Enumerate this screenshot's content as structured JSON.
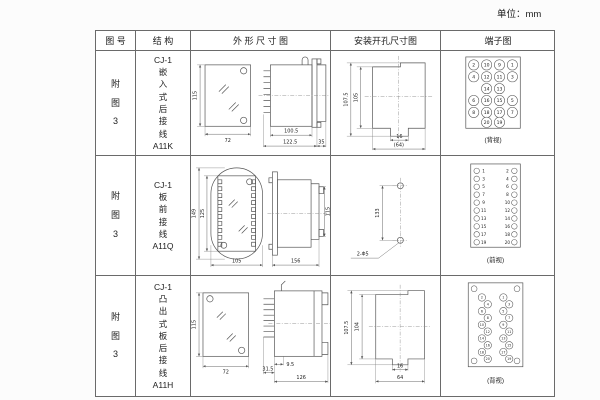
{
  "unit_label": "单位：mm",
  "header": {
    "col_figure": "图 号",
    "col_structure": "结 构",
    "col_outline": "外 形 尺 寸 图",
    "col_install": "安装开孔尺寸图",
    "col_terminal": "端子图"
  },
  "rows": [
    {
      "figure": "附\n图\n3",
      "structure": "CJ-1\n嵌\n入\n式\n后\n接\n线\nA11K",
      "outline": {
        "front_h": "115",
        "front_w": "72",
        "side_body": "100.5",
        "side_total": "122.5",
        "side_rear": "35"
      },
      "install": {
        "outer_h": "107.5",
        "inner_h": "105",
        "notch_w": "16",
        "total_w": "(64)"
      },
      "terminal": {
        "view_label": "(背视)",
        "circles": [
          {
            "x": 33,
            "y": 14,
            "n": "2"
          },
          {
            "x": 46,
            "y": 14,
            "n": "10"
          },
          {
            "x": 59,
            "y": 14,
            "n": "9"
          },
          {
            "x": 72,
            "y": 14,
            "n": "1"
          },
          {
            "x": 33,
            "y": 26,
            "n": "4"
          },
          {
            "x": 46,
            "y": 26,
            "n": "12"
          },
          {
            "x": 59,
            "y": 26,
            "n": "11"
          },
          {
            "x": 72,
            "y": 26,
            "n": "3"
          },
          {
            "x": 46,
            "y": 38,
            "n": "14"
          },
          {
            "x": 59,
            "y": 38,
            "n": "13"
          },
          {
            "x": 33,
            "y": 50,
            "n": "6"
          },
          {
            "x": 46,
            "y": 50,
            "n": "16"
          },
          {
            "x": 59,
            "y": 50,
            "n": "15"
          },
          {
            "x": 72,
            "y": 50,
            "n": "5"
          },
          {
            "x": 33,
            "y": 62,
            "n": "8"
          },
          {
            "x": 46,
            "y": 62,
            "n": "18"
          },
          {
            "x": 59,
            "y": 62,
            "n": "17"
          },
          {
            "x": 72,
            "y": 62,
            "n": "7"
          },
          {
            "x": 46,
            "y": 72,
            "n": "20"
          },
          {
            "x": 59,
            "y": 72,
            "n": "19"
          }
        ]
      }
    },
    {
      "figure": "附\n图\n3",
      "structure": "CJ-1\n板\n前\n接\n线\nA11Q",
      "outline": {
        "front_outer_h": "149",
        "front_inner_h": "125",
        "front_w": "105",
        "side_len": "156",
        "side_h": "115"
      },
      "install": {
        "pitch": "133",
        "holes": "2-Φ5"
      },
      "terminal": {
        "view_label": "(前视)",
        "circles": [
          {
            "x": 36,
            "y": 15,
            "r": 2.8
          },
          {
            "x": 43,
            "y": 15,
            "r": 0,
            "n": "1"
          },
          {
            "x": 67,
            "y": 15,
            "r": 0,
            "n": "2"
          },
          {
            "x": 74,
            "y": 15,
            "r": 2.8
          },
          {
            "x": 36,
            "y": 23,
            "r": 2.8
          },
          {
            "x": 43,
            "y": 23,
            "r": 0,
            "n": "3"
          },
          {
            "x": 67,
            "y": 23,
            "r": 0,
            "n": "4"
          },
          {
            "x": 74,
            "y": 23,
            "r": 2.8
          },
          {
            "x": 36,
            "y": 31,
            "r": 2.8
          },
          {
            "x": 43,
            "y": 31,
            "r": 0,
            "n": "5"
          },
          {
            "x": 67,
            "y": 31,
            "r": 0,
            "n": "6"
          },
          {
            "x": 74,
            "y": 31,
            "r": 2.8
          },
          {
            "x": 36,
            "y": 39,
            "r": 2.8
          },
          {
            "x": 43,
            "y": 39,
            "r": 0,
            "n": "7"
          },
          {
            "x": 67,
            "y": 39,
            "r": 0,
            "n": "8"
          },
          {
            "x": 74,
            "y": 39,
            "r": 2.8
          },
          {
            "x": 36,
            "y": 47,
            "r": 2.8
          },
          {
            "x": 43,
            "y": 47,
            "r": 0,
            "n": "9"
          },
          {
            "x": 67,
            "y": 47,
            "r": 0,
            "n": "10"
          },
          {
            "x": 74,
            "y": 47,
            "r": 2.8
          },
          {
            "x": 36,
            "y": 55,
            "r": 2.8
          },
          {
            "x": 43,
            "y": 55,
            "r": 0,
            "n": "11"
          },
          {
            "x": 67,
            "y": 55,
            "r": 0,
            "n": "12"
          },
          {
            "x": 74,
            "y": 55,
            "r": 2.8
          },
          {
            "x": 36,
            "y": 63,
            "r": 2.8
          },
          {
            "x": 43,
            "y": 63,
            "r": 0,
            "n": "13"
          },
          {
            "x": 67,
            "y": 63,
            "r": 0,
            "n": "14"
          },
          {
            "x": 74,
            "y": 63,
            "r": 2.8
          },
          {
            "x": 36,
            "y": 71,
            "r": 2.8
          },
          {
            "x": 43,
            "y": 71,
            "r": 0,
            "n": "15"
          },
          {
            "x": 67,
            "y": 71,
            "r": 0,
            "n": "16"
          },
          {
            "x": 74,
            "y": 71,
            "r": 2.8
          },
          {
            "x": 36,
            "y": 79,
            "r": 2.8
          },
          {
            "x": 43,
            "y": 79,
            "r": 0,
            "n": "17"
          },
          {
            "x": 67,
            "y": 79,
            "r": 0,
            "n": "18"
          },
          {
            "x": 74,
            "y": 79,
            "r": 2.8
          },
          {
            "x": 36,
            "y": 87,
            "r": 2.8
          },
          {
            "x": 43,
            "y": 87,
            "r": 0,
            "n": "19"
          },
          {
            "x": 67,
            "y": 87,
            "r": 0,
            "n": "20"
          },
          {
            "x": 74,
            "y": 87,
            "r": 2.8
          }
        ]
      }
    },
    {
      "figure": "附\n图\n3",
      "structure": "CJ-1\n凸\n出\n式\n板\n后\n接\n线\nA11H",
      "outline": {
        "front_h": "115",
        "front_w": "72",
        "side_a": "9.5",
        "side_b": "31.5",
        "side_len": "126"
      },
      "install": {
        "outer_h": "107.5",
        "inner_h": "104",
        "notch_w": "16",
        "total_w": "64"
      },
      "terminal": {
        "view_label": "(背视)",
        "circles": [
          {
            "x": 33,
            "y": 12,
            "r": 3
          },
          {
            "x": 77,
            "y": 12,
            "r": 3
          },
          {
            "x": 33,
            "y": 86,
            "r": 3
          },
          {
            "x": 77,
            "y": 86,
            "r": 3
          },
          {
            "x": 41,
            "y": 21,
            "n": "2"
          },
          {
            "x": 47,
            "y": 28,
            "n": "4"
          },
          {
            "x": 41,
            "y": 35,
            "n": "6"
          },
          {
            "x": 47,
            "y": 42,
            "n": "8"
          },
          {
            "x": 41,
            "y": 49,
            "n": "10"
          },
          {
            "x": 47,
            "y": 56,
            "n": "12"
          },
          {
            "x": 41,
            "y": 63,
            "n": "14"
          },
          {
            "x": 47,
            "y": 70,
            "n": "16"
          },
          {
            "x": 41,
            "y": 77,
            "n": "18"
          },
          {
            "x": 47,
            "y": 84,
            "n": "20"
          },
          {
            "x": 63,
            "y": 21,
            "n": "1"
          },
          {
            "x": 69,
            "y": 28,
            "n": "3"
          },
          {
            "x": 63,
            "y": 35,
            "n": "5"
          },
          {
            "x": 69,
            "y": 42,
            "n": "7"
          },
          {
            "x": 63,
            "y": 49,
            "n": "9"
          },
          {
            "x": 69,
            "y": 56,
            "n": "11"
          },
          {
            "x": 63,
            "y": 63,
            "n": "13"
          },
          {
            "x": 69,
            "y": 70,
            "n": "15"
          },
          {
            "x": 63,
            "y": 77,
            "n": "17"
          },
          {
            "x": 69,
            "y": 84,
            "n": "19"
          }
        ]
      }
    }
  ]
}
